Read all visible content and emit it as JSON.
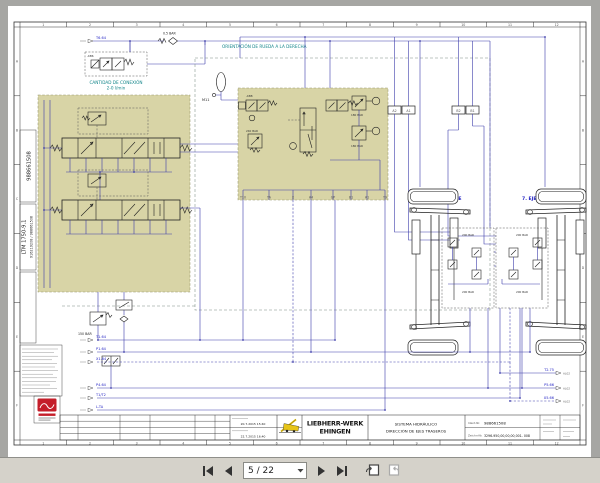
{
  "toolbar": {
    "page_indicator": "5 / 22"
  },
  "colors": {
    "block_khaki": "#d8d4a6",
    "line_navy": "#3c3caa",
    "label_blue": "#2424c4",
    "heading_teal": "#14868a",
    "logo_red": "#c41e2a",
    "logo_yellow": "#e6c417",
    "toolbar_gray": "#d5d2ca"
  },
  "drawing": {
    "left_strip": {
      "doc_no": "988661508",
      "model": "LTM 1750-9.1",
      "ident": "916219208 / 988661508"
    },
    "headings": {
      "orientation": "ORIENTACIÓN DE RUEDA A LA DERECHA",
      "flow_note_line1": "CANTIDAD DE CONEXIÓN",
      "flow_note_line2": "2-0 l/min"
    },
    "labels": {
      "bar05": "0.5 BAR",
      "bar150": "150 BAR",
      "bar180": "180 BAR",
      "bar240": "240 BAR",
      "bar200": "200 BAR",
      "m11": "M11",
      "kb8": "-KB8",
      "kb6": "-KB6",
      "axle6": "6. EJE",
      "axle7": "7. EJE"
    },
    "mid_ports_bottom": [
      "T10",
      "TA",
      "X",
      "A4",
      "GP",
      "B1",
      "A1",
      "T9"
    ],
    "mid_ports_top": [
      "A2",
      "A1",
      "B2",
      "B1"
    ],
    "left_connectors": {
      "top": "T6.64",
      "r1": "T1.64",
      "r2": "P1.64",
      "r3": "X1.64",
      "r4": "P4.64",
      "r5": "T1/T2",
      "r6": "L-TA"
    },
    "right_connectors": {
      "r1": "T2.75",
      "r2": "P5.66",
      "r3": "X5.66",
      "tag": "AL02"
    },
    "frame": {
      "cols": [
        "1",
        "2",
        "3",
        "4",
        "5",
        "6",
        "7",
        "8",
        "9",
        "10",
        "11",
        "12"
      ],
      "rows": [
        "A",
        "B",
        "C",
        "D",
        "E",
        "F"
      ]
    },
    "titleblock": {
      "date1": "20.7.2015 15:40",
      "date2": "22.7.2015 16:40",
      "company_line1": "LIEBHERR-WERK",
      "company_line2": "EHINGEN",
      "title_line1": "SISTEMA HIDRÁULICO",
      "title_line2": "DIRECCIÓN DE EJES TRASEROS",
      "ident_label": "Ident-Nr.",
      "ident_value": "988661508",
      "drawing_label": "Zeichn-Nr.",
      "drawing_value": "3296-950,00,00,00,001- 008"
    }
  }
}
